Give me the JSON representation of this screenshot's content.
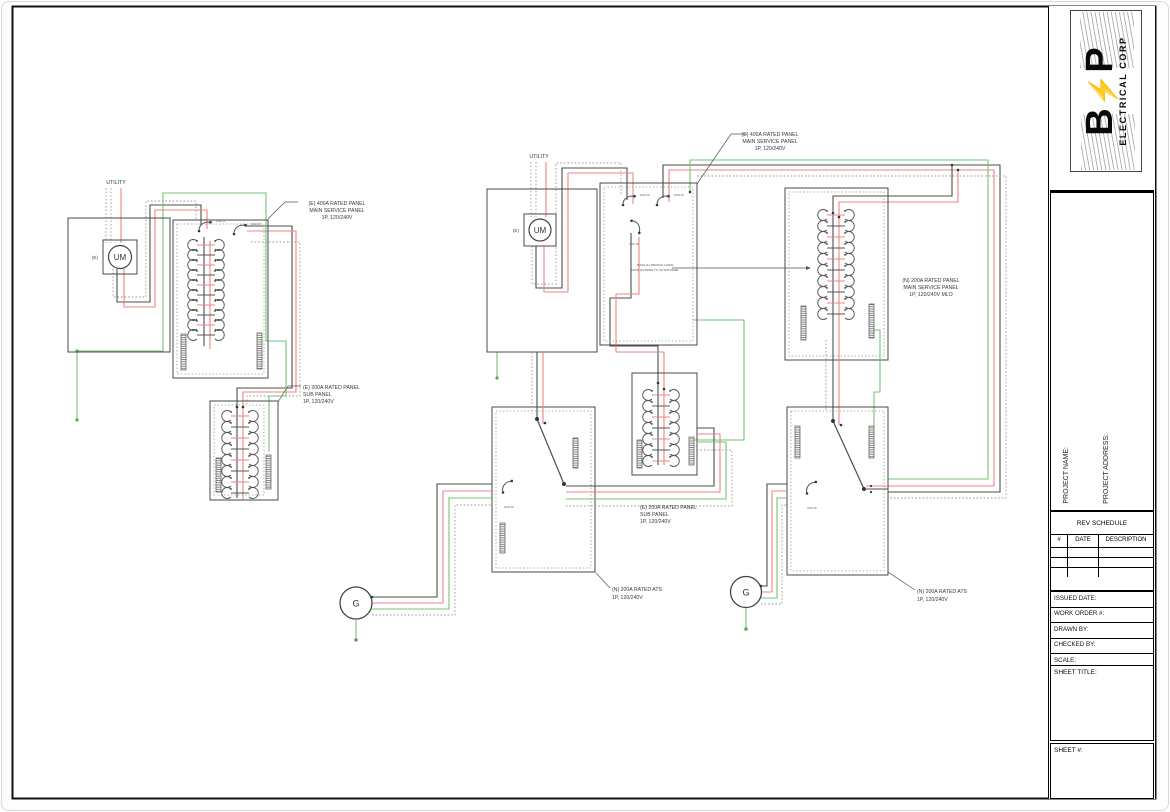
{
  "titleblock": {
    "logo_b": "B",
    "logo_bolt": "⚡",
    "logo_p": "P",
    "logo_subtitle": "ELECTRICAL CORP",
    "project_name_label": "PROJECT NAME:",
    "project_address_label": "PROJECT ADDRESS:",
    "rev_title": "REV SCHEDULE",
    "rev_columns": [
      "#",
      "DATE",
      "DESCRIPTION"
    ],
    "issued_date_label": "ISSUED DATE:",
    "work_order_label": "WORK ORDER #:",
    "drawn_by_label": "DRAWN BY:",
    "checked_by_label": "CHECKED BY:",
    "scale_label": "SCALE:",
    "sheet_title_label": "SHEET TITLE:",
    "sheet_number_label": "SHEET #:"
  },
  "diagram": {
    "utility_label": "UTILITY",
    "existing_tag": "(E)",
    "meter_label": "UM",
    "generator_label": "G",
    "breaker_tag": "200A 2P",
    "note_line1": "MOVE ALL BRANCH LOADS",
    "note_line2": "FROM (E) PANEL TO (N) SUB PANEL",
    "left_main_panel": [
      "(E) 400A RATED PANEL",
      "MAIN SERVICE PANEL",
      "1P, 120/240V"
    ],
    "left_sub_panel": [
      "(E) 200A RATED PANEL",
      "SUB PANEL",
      "1P, 120/240V"
    ],
    "mid_main_panel": [
      "(E) 400A RATED PANEL",
      "MAIN SERVICE PANEL",
      "1P, 120/240V"
    ],
    "mid_sub_panel": [
      "(E) 200A RATED PANEL",
      "SUB PANEL",
      "1P, 120/240V"
    ],
    "mid_ats": [
      "(N) 200A RATED ATS",
      "1P, 120/240V"
    ],
    "right_main_panel": [
      "(N) 200A RATED PANEL",
      "MAIN SERVICE PANEL",
      "1P, 120/240V MLO"
    ],
    "right_ats": [
      "(N) 200A RATED ATS",
      "1P, 120/240V"
    ]
  },
  "colors": {
    "wire_neutral": "#4d4d4d",
    "wire_hot": "#ee8585",
    "wire_ground": "#72c472",
    "conduit": "#9a9a9a"
  }
}
